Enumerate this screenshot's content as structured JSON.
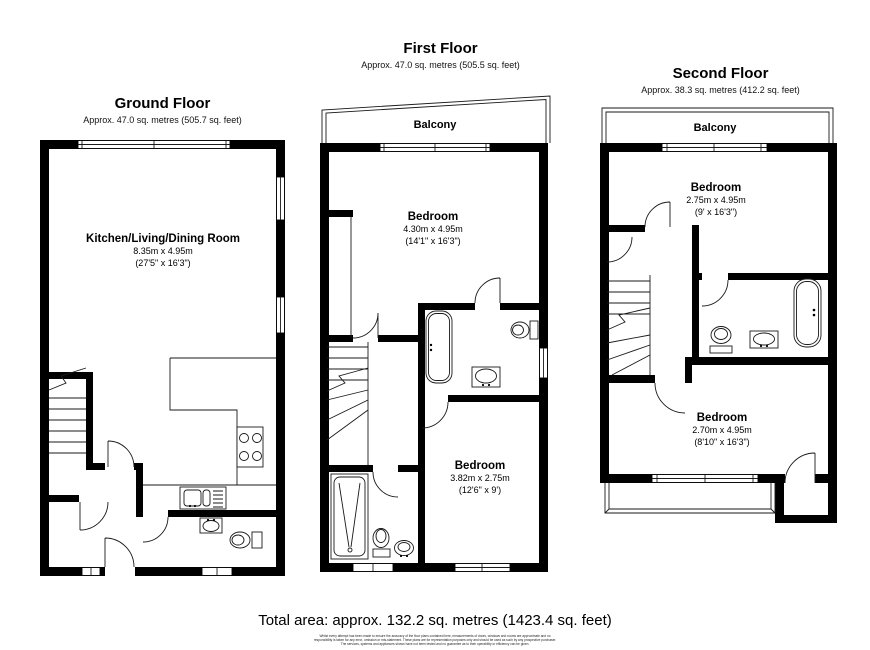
{
  "page": {
    "background": "#ffffff",
    "wall_color": "#000000",
    "line_color": "#1a1a1a"
  },
  "floors": [
    {
      "id": "ground",
      "title": "Ground Floor",
      "subtitle": "Approx. 47.0 sq. metres (505.7 sq. feet)",
      "rooms": [
        {
          "name": "Kitchen/Living/Dining Room",
          "dims_metric": "8.35m x 4.95m",
          "dims_imperial": "(27'5\" x 16'3\")"
        }
      ]
    },
    {
      "id": "first",
      "title": "First Floor",
      "subtitle": "Approx. 47.0 sq. metres (505.5 sq. feet)",
      "balcony_label": "Balcony",
      "rooms": [
        {
          "name": "Bedroom",
          "dims_metric": "4.30m x 4.95m",
          "dims_imperial": "(14'1\" x 16'3\")"
        },
        {
          "name": "Bedroom",
          "dims_metric": "3.82m x 2.75m",
          "dims_imperial": "(12'6\" x 9')"
        }
      ]
    },
    {
      "id": "second",
      "title": "Second Floor",
      "subtitle": "Approx. 38.3 sq. metres (412.2 sq. feet)",
      "balcony_label": "Balcony",
      "rooms": [
        {
          "name": "Bedroom",
          "dims_metric": "2.75m x 4.95m",
          "dims_imperial": "(9' x 16'3\")"
        },
        {
          "name": "Bedroom",
          "dims_metric": "2.70m x 4.95m",
          "dims_imperial": "(8'10\" x 16'3\")"
        }
      ]
    }
  ],
  "footer": {
    "total_area": "Total area: approx. 132.2 sq. metres (1423.4 sq. feet)",
    "disclaimer": "Whilst every attempt has been made to ensure the accuracy of the floor plans contained here, measurements of doors, windows and rooms are approximate and no responsibility is taken for any error, omission or mis-statement. These plans are for representation purposes only and should be used as such by any prospective purchaser. The services, systems and appliances shown have not been tested and no guarantee as to their operability or efficiency can be given."
  }
}
